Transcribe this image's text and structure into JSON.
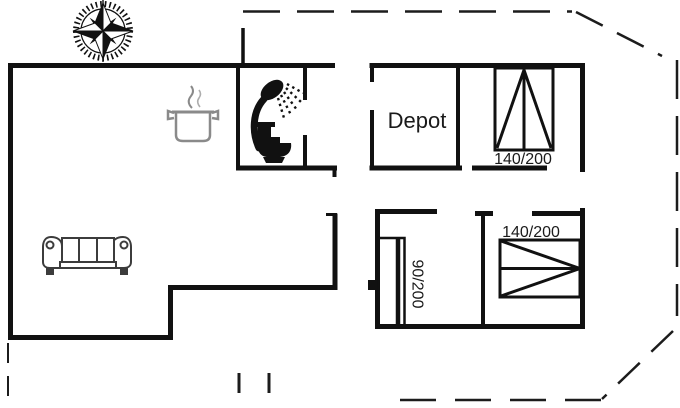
{
  "rooms": {
    "depot": {
      "label": "Depot"
    }
  },
  "beds": {
    "top_right_double": {
      "label": "140/200"
    },
    "bottom_single": {
      "label": "90/200"
    },
    "bottom_right_double": {
      "label": "140/200"
    }
  },
  "icons": {
    "compass": "compass-rose-icon",
    "cooking_pot": "cooking-pot-icon",
    "shower": "shower-icon",
    "toilet": "toilet-icon",
    "sofa": "sofa-icon"
  },
  "colors": {
    "wall": "#111111",
    "boundary": "#1c1c1c",
    "pot_gray": "#8a8a8a",
    "steam_gray": "#b0b0b0",
    "sofa_gray": "#3c3c3c",
    "fixture_black": "#111111",
    "text": "#1a1a1a",
    "background": "#ffffff"
  }
}
